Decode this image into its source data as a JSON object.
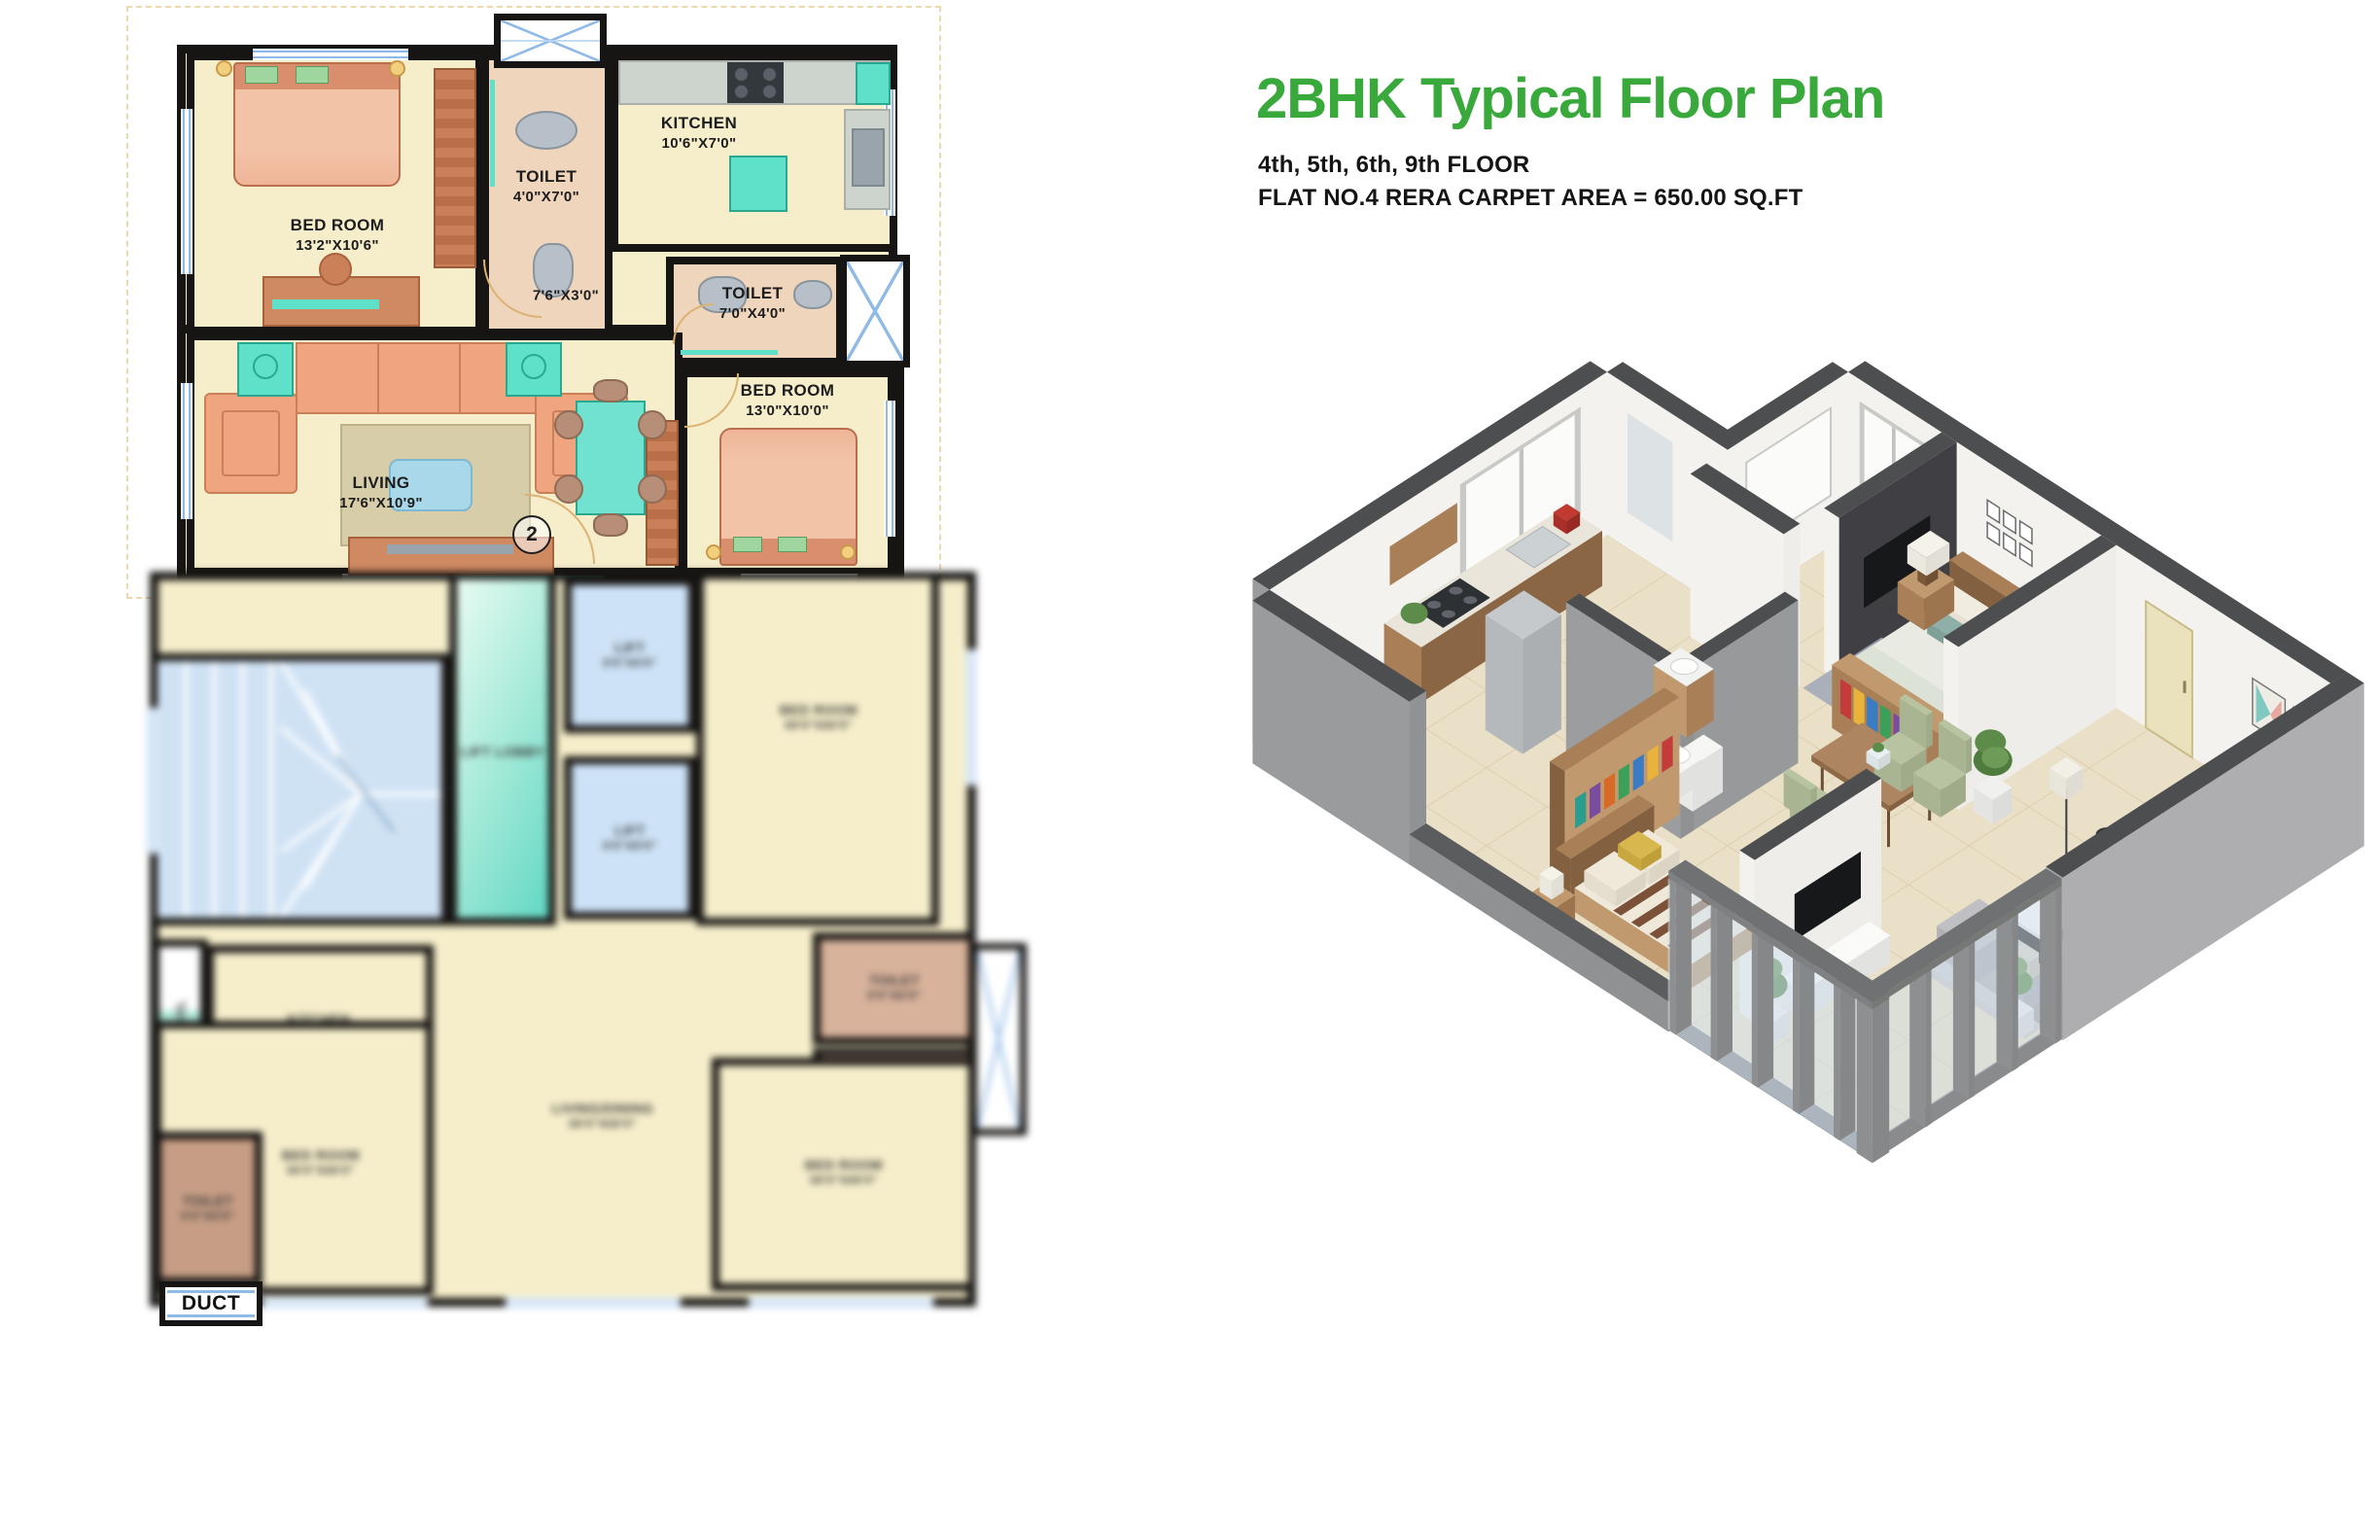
{
  "palette": {
    "title_green": "#3aa93c",
    "ink": "#141414",
    "wall": "#171513",
    "beige": "#f6eecb",
    "pink": "#f0d5bd",
    "brown": "#cb8058",
    "brown_dark": "#a8623e",
    "teal": "#5fe0c8",
    "window_blue": "#8fb9e6",
    "stair_blue": "#cfe2f4",
    "lift_blue": "#cde2f6",
    "mint": "#9fe8d6",
    "gray_fix": "#b7c0c8"
  },
  "header": {
    "title": "2BHK Typical Floor Plan",
    "subtitle_line1": "4th, 5th, 6th, 9th FLOOR",
    "subtitle_line2": "FLAT NO.4 RERA CARPET AREA = 650.00 SQ.FT"
  },
  "upper_plan": {
    "bedroom1": {
      "name": "BED ROOM",
      "dims": "13'2\"X10'6\""
    },
    "toilet1": {
      "name": "TOILET",
      "dims": "4'0\"X7'0\""
    },
    "kitchen": {
      "name": "KITCHEN",
      "dims": "10'6\"X7'0\""
    },
    "passage_dims": "7'6\"X3'0\"",
    "toilet2": {
      "name": "TOILET",
      "dims": "7'0\"X4'0\""
    },
    "bedroom2": {
      "name": "BED ROOM",
      "dims": "13'0\"X10'0\""
    },
    "living": {
      "name": "LIVING",
      "dims": "17'6\"X10'9\""
    },
    "flat_number": "2"
  },
  "lower_plan": {
    "lift_lobby": "LIFT LOBBY",
    "lift": "LIFT",
    "lift_dims": "0'0\"X0'0\"",
    "bedroom": "BED ROOM",
    "bedroom_dims": "00'0\"X00'0\"",
    "toilet": "TOILET",
    "toilet_dims": "0'0\"X0'0\"",
    "kitchen": "KITCHEN",
    "kitchen_dims": "0'0\"X0'0\"",
    "living": "LIVING/DINING",
    "living_dims": "00'0\"X00'0\"",
    "balcony": "BAL",
    "duct": "DUCT"
  }
}
